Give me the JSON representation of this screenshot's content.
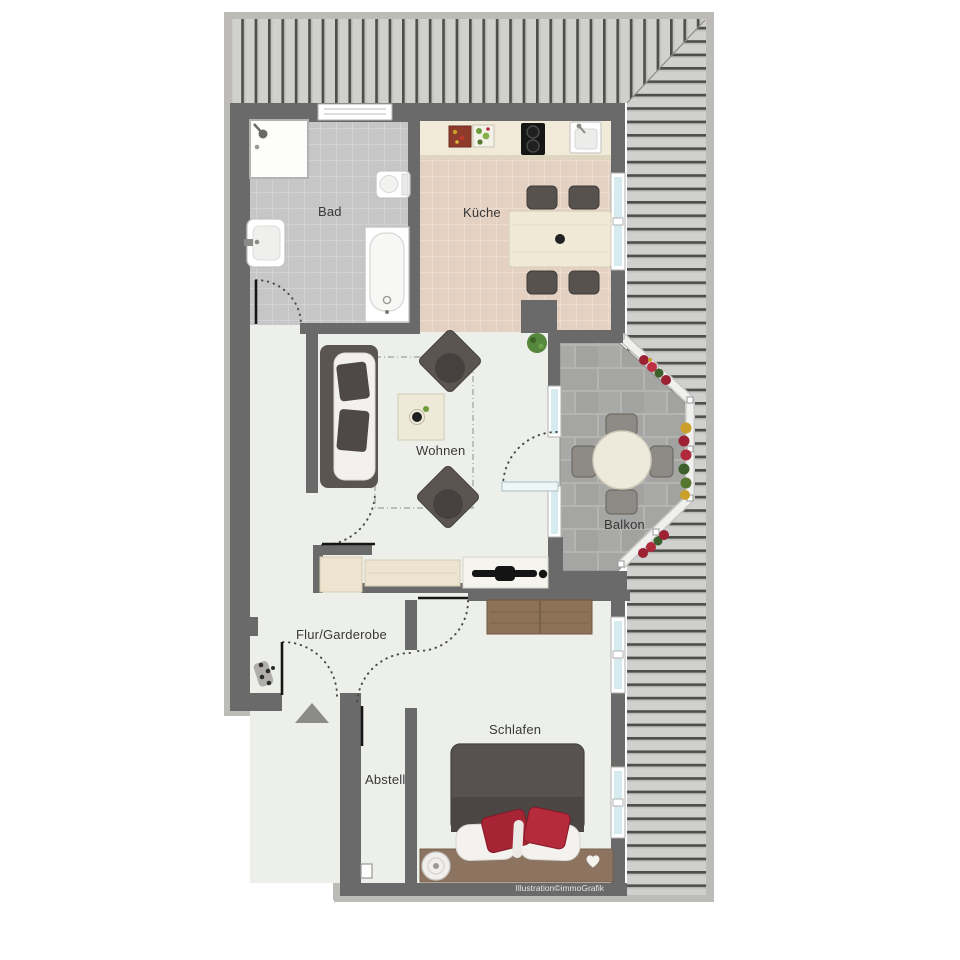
{
  "rooms": {
    "bad": "Bad",
    "kueche": "Küche",
    "wohnen": "Wohnen",
    "balkon": "Balkon",
    "flur": "Flur/Garderobe",
    "abstell": "Abstell",
    "schlafen": "Schlafen"
  },
  "watermark": "Illustration©immoGrafik",
  "colors": {
    "wall": "#6a6a6a",
    "roof_stripe": "#4e4e4c",
    "roof_background": "#d0d0ce",
    "outer_border": "#bdbbb7",
    "interior_floor": "#edefeb",
    "bad_floor": "#c6c6c6",
    "kueche_floor": "#e5d1c2",
    "balcony_pavement": "#a5a5a3",
    "furniture_dark": "#57524e",
    "wood": "#8c7460",
    "accent_red": "#a62434",
    "window_glass": "#d6ebf0"
  }
}
